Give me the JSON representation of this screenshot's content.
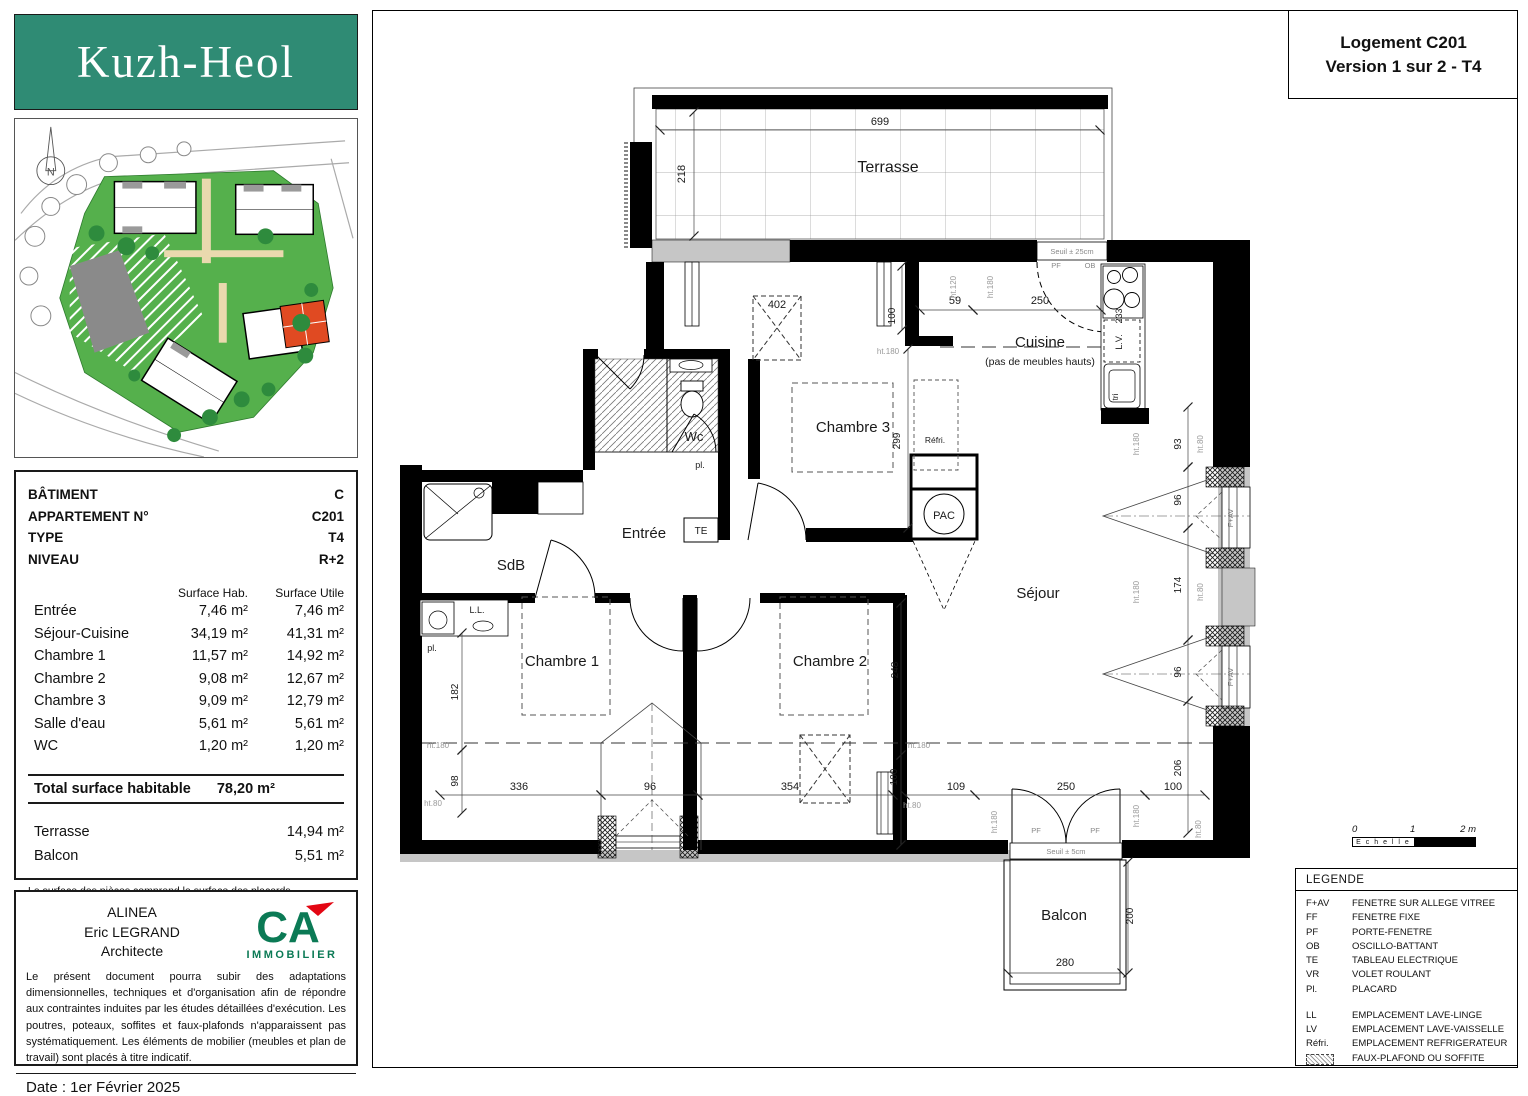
{
  "header": {
    "logo": "Kuzh-Heol",
    "title_line1": "Logement C201",
    "title_line2": "Version 1 sur 2 - T4"
  },
  "site": {
    "compass": "N"
  },
  "info_table": {
    "rows": [
      {
        "label": "BÂTIMENT",
        "value": "C"
      },
      {
        "label": "APPARTEMENT N°",
        "value": "C201"
      },
      {
        "label": "TYPE",
        "value": "T4"
      },
      {
        "label": "NIVEAU",
        "value": "R+2"
      }
    ],
    "col_headers": [
      "Surface Hab.",
      "Surface Utile"
    ],
    "surfaces": [
      {
        "room": "Entrée",
        "hab": "7,46 m²",
        "utile": "7,46 m²"
      },
      {
        "room": "Séjour-Cuisine",
        "hab": "34,19 m²",
        "utile": "41,31 m²"
      },
      {
        "room": "Chambre 1",
        "hab": "11,57 m²",
        "utile": "14,92 m²"
      },
      {
        "room": "Chambre 2",
        "hab": "9,08 m²",
        "utile": "12,67 m²"
      },
      {
        "room": "Chambre 3",
        "hab": "9,09 m²",
        "utile": "12,79 m²"
      },
      {
        "room": "Salle d'eau",
        "hab": "5,61 m²",
        "utile": "5,61 m²"
      },
      {
        "room": "WC",
        "hab": "1,20 m²",
        "utile": "1,20 m²"
      }
    ],
    "total_label": "Total surface habitable",
    "total_value": "78,20 m²",
    "extras": [
      {
        "room": "Terrasse",
        "value": "14,94 m²"
      },
      {
        "room": "Balcon",
        "value": "5,51 m²"
      }
    ],
    "footnote": "La surface des pièces comprend la surface des placards"
  },
  "architect": {
    "lines": [
      "ALINEA",
      "Eric LEGRAND",
      "Architecte"
    ],
    "logo_text": "CA",
    "logo_sub": "IMMOBILIER",
    "disclaimer": "Le présent document pourra subir des adaptations dimensionnelles, techniques et d'organisation afin de répondre aux contraintes induites par les études détaillées d'exécution. Les poutres, poteaux, soffites et faux-plafonds n'apparaissent pas systématiquement. Les éléments de mobilier (meubles et plan de travail) sont placés à titre indicatif.",
    "date": "Date : 1er Février 2025"
  },
  "legend": {
    "title": "LEGENDE",
    "items": [
      {
        "abbr": "F+AV",
        "label": "FENETRE SUR ALLEGE VITREE"
      },
      {
        "abbr": "FF",
        "label": "FENETRE FIXE"
      },
      {
        "abbr": "PF",
        "label": "PORTE-FENETRE"
      },
      {
        "abbr": "OB",
        "label": "OSCILLO-BATTANT"
      },
      {
        "abbr": "TE",
        "label": "TABLEAU ELECTRIQUE"
      },
      {
        "abbr": "VR",
        "label": "VOLET ROULANT"
      },
      {
        "abbr": "Pl.",
        "label": "PLACARD"
      }
    ],
    "items2": [
      {
        "abbr": "LL",
        "label": "EMPLACEMENT LAVE-LINGE"
      },
      {
        "abbr": "LV",
        "label": "EMPLACEMENT LAVE-VAISSELLE"
      },
      {
        "abbr": "Réfri.",
        "label": "EMPLACEMENT REFRIGERATEUR"
      }
    ],
    "hatch_label": "FAUX-PLAFOND OU SOFFITE"
  },
  "scalebar": {
    "label": "E c h e l l e",
    "ticks": [
      "0",
      "1",
      "2 m"
    ]
  },
  "colors": {
    "logo_teal": "#2f8b74",
    "ca_green": "#0b7a55",
    "ca_red": "#e30613",
    "site_green": "#55b04c",
    "highlight_building": "#e04a22",
    "masonry_gray": "#c6c6c6",
    "wall_black": "#000000"
  },
  "plan": {
    "labels": [
      {
        "t": "Terrasse",
        "x": 888,
        "y": 172,
        "s": 16,
        "n": "room-terrasse"
      },
      {
        "t": "Cuisine",
        "x": 1040,
        "y": 347,
        "s": 15,
        "n": "room-cuisine"
      },
      {
        "t": "(pas de meubles hauts)",
        "x": 1040,
        "y": 365,
        "s": 10.5,
        "n": "room-cuisine-note"
      },
      {
        "t": "Chambre 3",
        "x": 853,
        "y": 432,
        "s": 15,
        "n": "room-chambre-3"
      },
      {
        "t": "Wc",
        "x": 694,
        "y": 441,
        "s": 13,
        "n": "room-wc"
      },
      {
        "t": "Entrée",
        "x": 644,
        "y": 538,
        "s": 15,
        "n": "room-entree"
      },
      {
        "t": "SdB",
        "x": 511,
        "y": 570,
        "s": 15,
        "n": "room-sdb"
      },
      {
        "t": "Chambre 1",
        "x": 562,
        "y": 666,
        "s": 15,
        "n": "room-chambre-1"
      },
      {
        "t": "Chambre 2",
        "x": 830,
        "y": 666,
        "s": 15,
        "n": "room-chambre-2"
      },
      {
        "t": "Séjour",
        "x": 1038,
        "y": 598,
        "s": 15,
        "n": "room-sejour"
      },
      {
        "t": "Balcon",
        "x": 1064,
        "y": 920,
        "s": 15,
        "n": "room-balcon"
      },
      {
        "t": "PAC",
        "x": 944,
        "y": 519,
        "s": 11,
        "n": "label-pac"
      },
      {
        "t": "TE",
        "x": 701,
        "y": 534,
        "s": 10,
        "n": "label-te"
      },
      {
        "t": "pl.",
        "x": 700,
        "y": 468,
        "s": 9,
        "n": "label-placard-wc"
      },
      {
        "t": "pl.",
        "x": 432,
        "y": 651,
        "s": 9,
        "n": "label-placard-sdb"
      },
      {
        "t": "L.L.",
        "x": 477,
        "y": 613,
        "s": 9,
        "n": "label-lave-linge"
      },
      {
        "t": "Réfri.",
        "x": 935,
        "y": 443,
        "s": 8.5,
        "n": "label-refrigerateur"
      },
      {
        "t": "L.V.",
        "x": 1122,
        "y": 342,
        "s": 9,
        "r": -90,
        "n": "label-lave-vaisselle"
      },
      {
        "t": "233",
        "x": 1122,
        "y": 316,
        "s": 9,
        "r": -90,
        "n": "dim-lv"
      },
      {
        "t": "tri",
        "x": 1118,
        "y": 397,
        "s": 8,
        "r": -90,
        "n": "label-tri"
      },
      {
        "t": "699",
        "x": 880,
        "y": 125,
        "n": "dim"
      },
      {
        "t": "218",
        "x": 685,
        "y": 174,
        "r": -90,
        "n": "dim"
      },
      {
        "t": "402",
        "x": 777,
        "y": 308,
        "n": "dim"
      },
      {
        "t": "100",
        "x": 895,
        "y": 316,
        "s": 10,
        "r": -90,
        "n": "dim"
      },
      {
        "t": "59",
        "x": 955,
        "y": 304,
        "n": "dim"
      },
      {
        "t": "250",
        "x": 1040,
        "y": 304,
        "n": "dim"
      },
      {
        "t": "299",
        "x": 900,
        "y": 441,
        "s": 10,
        "r": -90,
        "n": "dim"
      },
      {
        "t": "93",
        "x": 1181,
        "y": 444,
        "s": 10,
        "r": -90,
        "n": "dim"
      },
      {
        "t": "96",
        "x": 1181,
        "y": 500,
        "s": 10,
        "r": -90,
        "n": "dim"
      },
      {
        "t": "174",
        "x": 1181,
        "y": 585,
        "s": 10,
        "r": -90,
        "n": "dim"
      },
      {
        "t": "96",
        "x": 1181,
        "y": 672,
        "s": 10,
        "r": -90,
        "n": "dim"
      },
      {
        "t": "206",
        "x": 1181,
        "y": 768,
        "s": 10,
        "r": -90,
        "n": "dim"
      },
      {
        "t": "248",
        "x": 898,
        "y": 670,
        "s": 10,
        "r": -90,
        "n": "dim"
      },
      {
        "t": "182",
        "x": 458,
        "y": 692,
        "s": 10,
        "r": -90,
        "n": "dim"
      },
      {
        "t": "98",
        "x": 458,
        "y": 781,
        "s": 10,
        "r": -90,
        "n": "dim"
      },
      {
        "t": "336",
        "x": 519,
        "y": 790,
        "n": "dim"
      },
      {
        "t": "96",
        "x": 650,
        "y": 790,
        "n": "dim"
      },
      {
        "t": "354",
        "x": 790,
        "y": 790,
        "n": "dim"
      },
      {
        "t": "100",
        "x": 897,
        "y": 777,
        "s": 10,
        "r": -90,
        "n": "dim"
      },
      {
        "t": "109",
        "x": 956,
        "y": 790,
        "n": "dim"
      },
      {
        "t": "250",
        "x": 1066,
        "y": 790,
        "n": "dim"
      },
      {
        "t": "100",
        "x": 1173,
        "y": 790,
        "n": "dim"
      },
      {
        "t": "280",
        "x": 1065,
        "y": 966,
        "n": "dim"
      },
      {
        "t": "200",
        "x": 1133,
        "y": 916,
        "s": 10,
        "r": -90,
        "n": "dim"
      },
      {
        "t": "Seuil ± 25cm",
        "x": 1072,
        "y": 254,
        "s": 7.5,
        "c": "#888",
        "n": "label-seuil-25"
      },
      {
        "t": "Seuil ± 5cm",
        "x": 1066,
        "y": 854,
        "s": 7.5,
        "c": "#888",
        "n": "label-seuil-5"
      },
      {
        "t": "ht.120",
        "x": 956,
        "y": 287,
        "s": 8,
        "r": -90,
        "c": "#999",
        "n": "ht"
      },
      {
        "t": "ht.180",
        "x": 993,
        "y": 287,
        "s": 8,
        "r": -90,
        "c": "#999",
        "n": "ht"
      },
      {
        "t": "ht.180",
        "x": 888,
        "y": 354,
        "s": 8,
        "c": "#999",
        "n": "ht"
      },
      {
        "t": "ht.180",
        "x": 438,
        "y": 748,
        "s": 8,
        "c": "#999",
        "n": "ht"
      },
      {
        "t": "ht.80",
        "x": 433,
        "y": 806,
        "s": 8,
        "c": "#999",
        "n": "ht"
      },
      {
        "t": "ht.180",
        "x": 919,
        "y": 748,
        "s": 8,
        "c": "#999",
        "n": "ht"
      },
      {
        "t": "ht.80",
        "x": 912,
        "y": 808,
        "s": 8,
        "c": "#999",
        "n": "ht"
      },
      {
        "t": "ht.180",
        "x": 1139,
        "y": 444,
        "s": 8,
        "r": -90,
        "c": "#999",
        "n": "ht"
      },
      {
        "t": "ht.80",
        "x": 1203,
        "y": 444,
        "s": 8,
        "r": -90,
        "c": "#999",
        "n": "ht"
      },
      {
        "t": "ht.180",
        "x": 1139,
        "y": 592,
        "s": 8,
        "r": -90,
        "c": "#999",
        "n": "ht"
      },
      {
        "t": "ht.80",
        "x": 1203,
        "y": 592,
        "s": 8,
        "r": -90,
        "c": "#999",
        "n": "ht"
      },
      {
        "t": "ht.180",
        "x": 997,
        "y": 822,
        "s": 8,
        "r": -90,
        "c": "#999",
        "n": "ht"
      },
      {
        "t": "ht.180",
        "x": 1139,
        "y": 816,
        "s": 8,
        "r": -90,
        "c": "#999",
        "n": "ht"
      },
      {
        "t": "ht.80",
        "x": 1201,
        "y": 829,
        "s": 8,
        "r": -90,
        "c": "#999",
        "n": "ht"
      },
      {
        "t": "F+AV",
        "x": 1233,
        "y": 518,
        "s": 7.5,
        "r": -90,
        "c": "#777",
        "n": "label-fav"
      },
      {
        "t": "F+AV",
        "x": 1233,
        "y": 677,
        "s": 7.5,
        "r": -90,
        "c": "#777",
        "n": "label-fav"
      },
      {
        "t": "PF",
        "x": 1036,
        "y": 833,
        "s": 7.5,
        "c": "#888",
        "n": "label-pf"
      },
      {
        "t": "PF",
        "x": 1095,
        "y": 833,
        "s": 7.5,
        "c": "#888",
        "n": "label-pf"
      },
      {
        "t": "PF",
        "x": 1056,
        "y": 268,
        "s": 7.5,
        "c": "#888",
        "n": "label-pf"
      },
      {
        "t": "OB",
        "x": 1090,
        "y": 268,
        "s": 7.5,
        "c": "#888",
        "n": "label-ob"
      }
    ]
  }
}
